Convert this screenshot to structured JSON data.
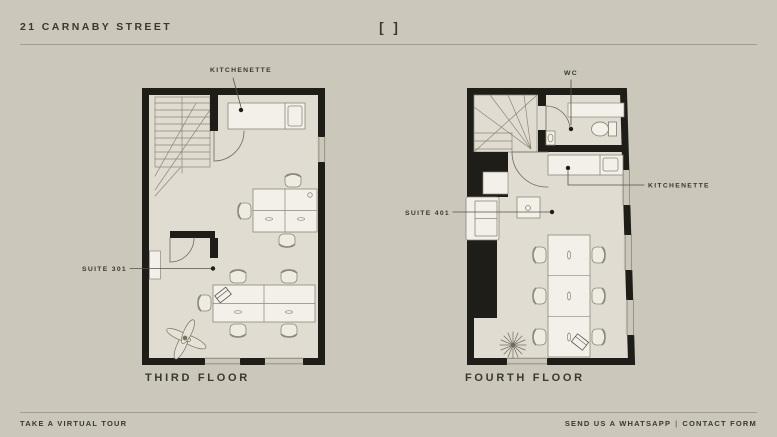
{
  "header": {
    "title": "21 CARNABY STREET",
    "fullscreen_icon": "[ ]"
  },
  "floors": [
    {
      "name": "THIRD FLOOR",
      "labels": {
        "kitchenette": "KITCHENETTE",
        "suite": "SUITE 301"
      }
    },
    {
      "name": "FOURTH FLOOR",
      "labels": {
        "wc": "WC",
        "kitchenette": "KITCHENETTE",
        "suite": "SUITE 401"
      }
    }
  ],
  "footer": {
    "virtual_tour": "TAKE A VIRTUAL TOUR",
    "whatsapp": "SEND US A WHATSAPP",
    "separator": "|",
    "contact": "CONTACT FORM"
  },
  "colors": {
    "background": "#cbc7bb",
    "floor": "#e0dcd2",
    "wall": "#1f1d18",
    "furniture": "#f3f0e9",
    "detail_line": "#8b8779",
    "text": "#3a382f"
  }
}
